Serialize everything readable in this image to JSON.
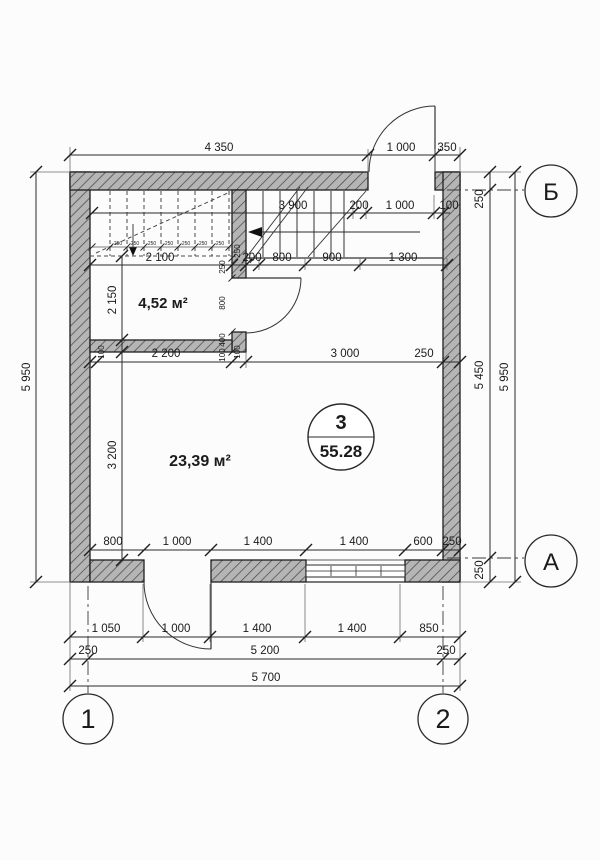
{
  "drawing": {
    "type": "architectural-floor-plan",
    "colors": {
      "ink": "#2a2a2a",
      "wall_fill": "#b5b5b5",
      "paper": "#fcfcfc"
    }
  },
  "rooms": {
    "small": {
      "area_label": "4,52 м²"
    },
    "main": {
      "area_label": "23,39 м²"
    },
    "badge": {
      "number": "3",
      "area": "55.28"
    }
  },
  "axes": {
    "col_1": "1",
    "col_2": "2",
    "row_b": "Б",
    "row_a": "А"
  },
  "dims": {
    "top_outer": [
      "4 350",
      "1 000",
      "350"
    ],
    "top_inner": [
      "3 900",
      "200",
      "1 000",
      "100"
    ],
    "treads": [
      "250",
      "250",
      "250",
      "250",
      "250",
      "250",
      "250"
    ],
    "stair_row": [
      "2 100",
      "250",
      "200",
      "800",
      "900",
      "1 300"
    ],
    "mid_row": [
      "100",
      "2 200",
      "100",
      "3 000",
      "250"
    ],
    "left_col": [
      "5 950",
      "2 150",
      "3 200"
    ],
    "right_col": [
      "250",
      "5 450",
      "5 950",
      "250"
    ],
    "partition_col": [
      "250",
      "800",
      "400",
      "100"
    ],
    "bottom_inner": [
      "800",
      "1 000",
      "1 400",
      "1 400",
      "600",
      "250"
    ],
    "bottom_row1": [
      "1 050",
      "1 000",
      "1 400",
      "1 400",
      "850"
    ],
    "bottom_row2": [
      "250",
      "5 200",
      "250"
    ],
    "bottom_row3": [
      "5 700"
    ]
  }
}
